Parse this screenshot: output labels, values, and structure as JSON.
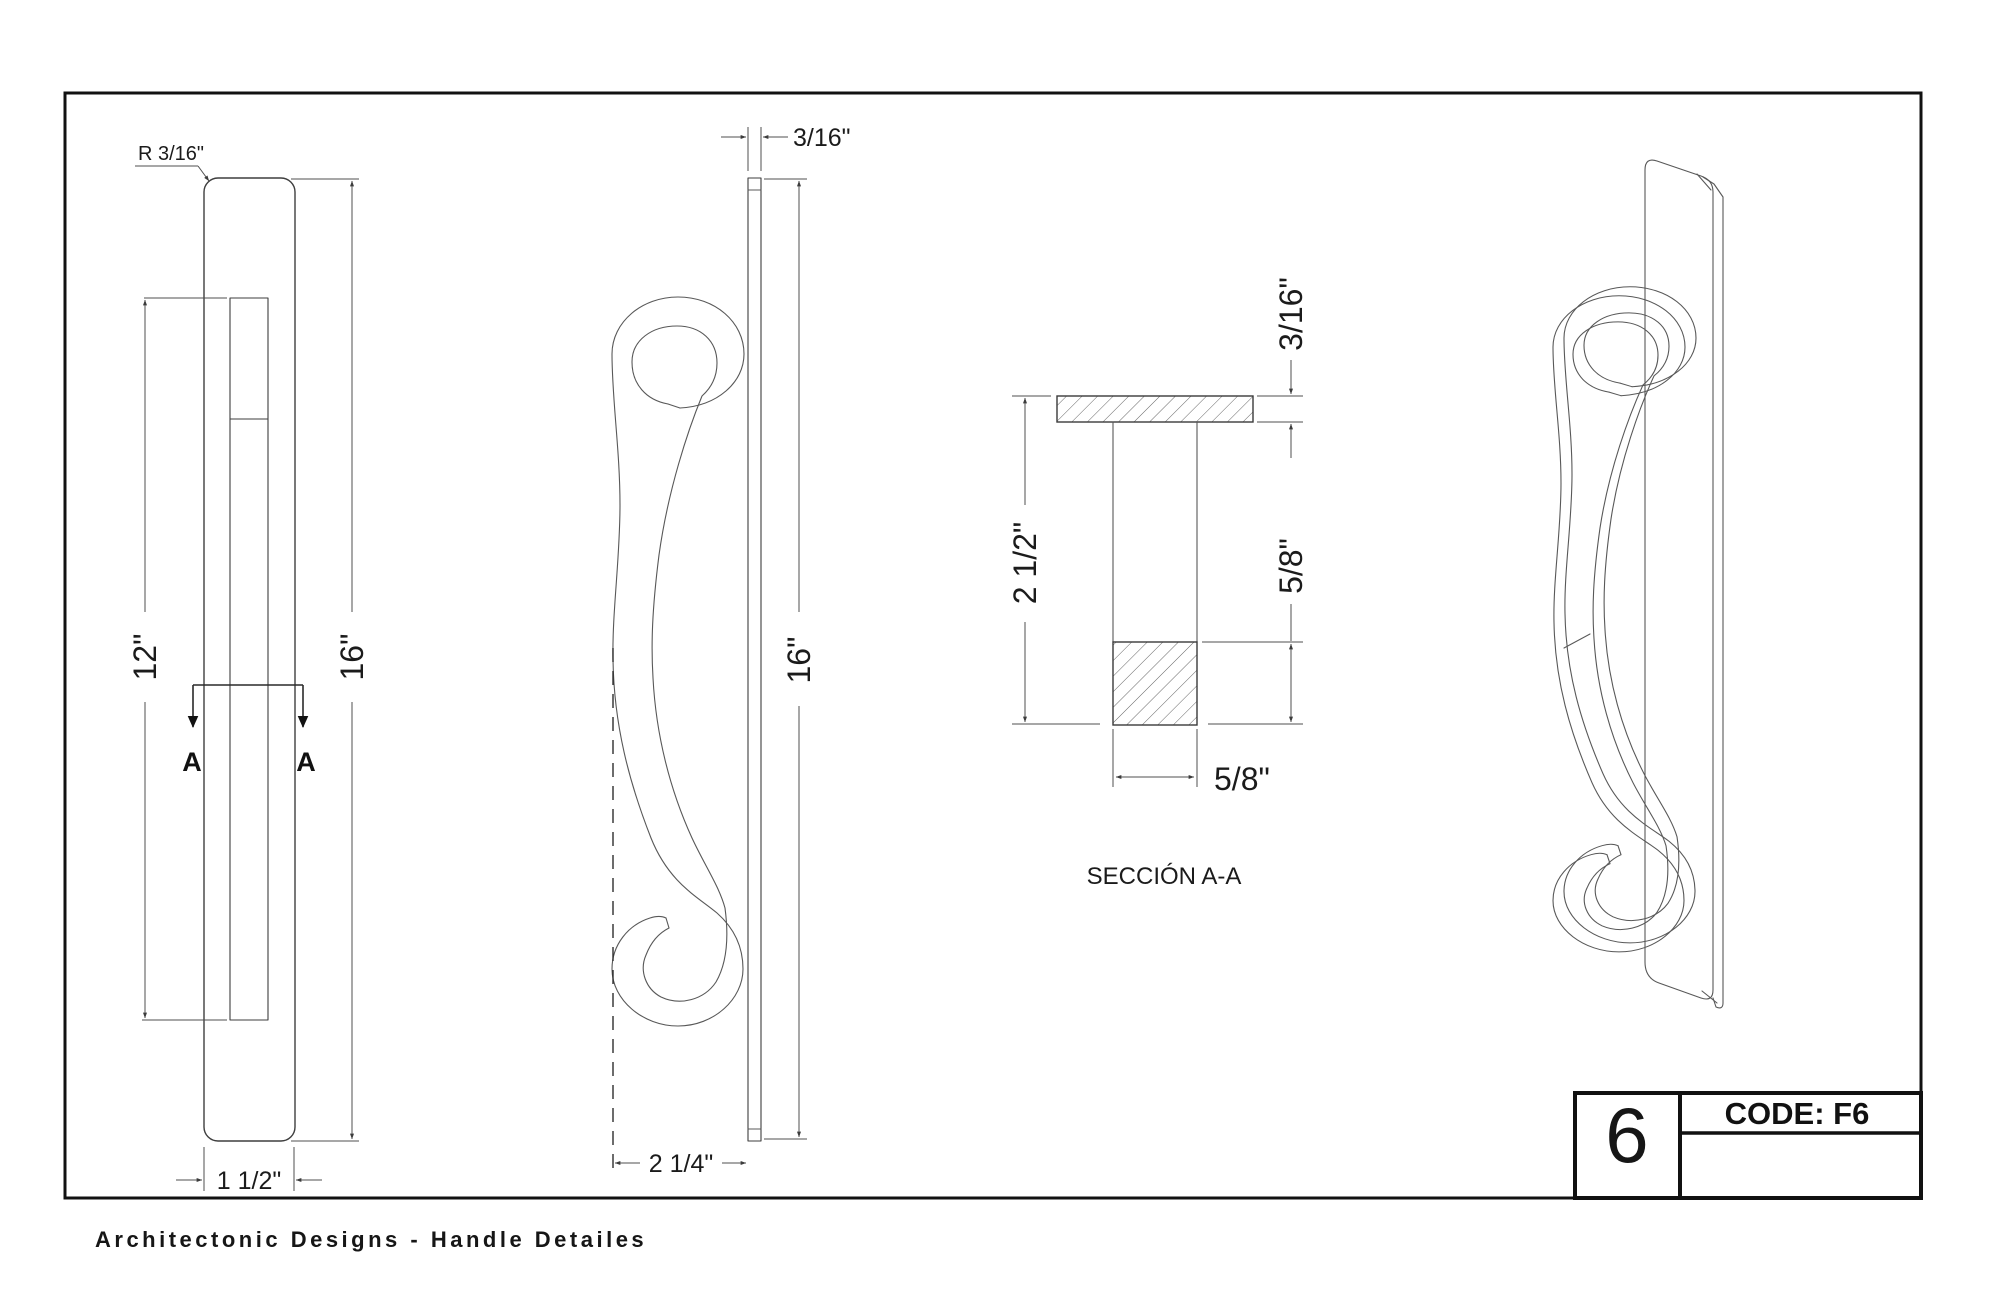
{
  "drawing": {
    "caption": "Architectonic Designs - Handle Detailes",
    "colors": {
      "line": "#3e3e3e",
      "dimension": "#4f4f4f",
      "text": "#1b1b1b",
      "frame": "#111111"
    },
    "front_view": {
      "radius_label": "R 3/16\"",
      "slot_height_label": "12\"",
      "height_label": "16\"",
      "width_label": "1 1/2\"",
      "section_letter_left": "A",
      "section_letter_right": "A"
    },
    "side_view": {
      "thickness_label": "3/16\"",
      "height_label": "16\"",
      "depth_label": "2 1/4\""
    },
    "section_view": {
      "title": "SECCIÓN A-A",
      "plate_thickness_label": "3/16\"",
      "depth_label": "2 1/2\"",
      "bar_height_label": "5/8\"",
      "bar_width_label": "5/8\""
    },
    "title_block": {
      "sheet_number": "6",
      "code": "CODE: F6"
    }
  }
}
